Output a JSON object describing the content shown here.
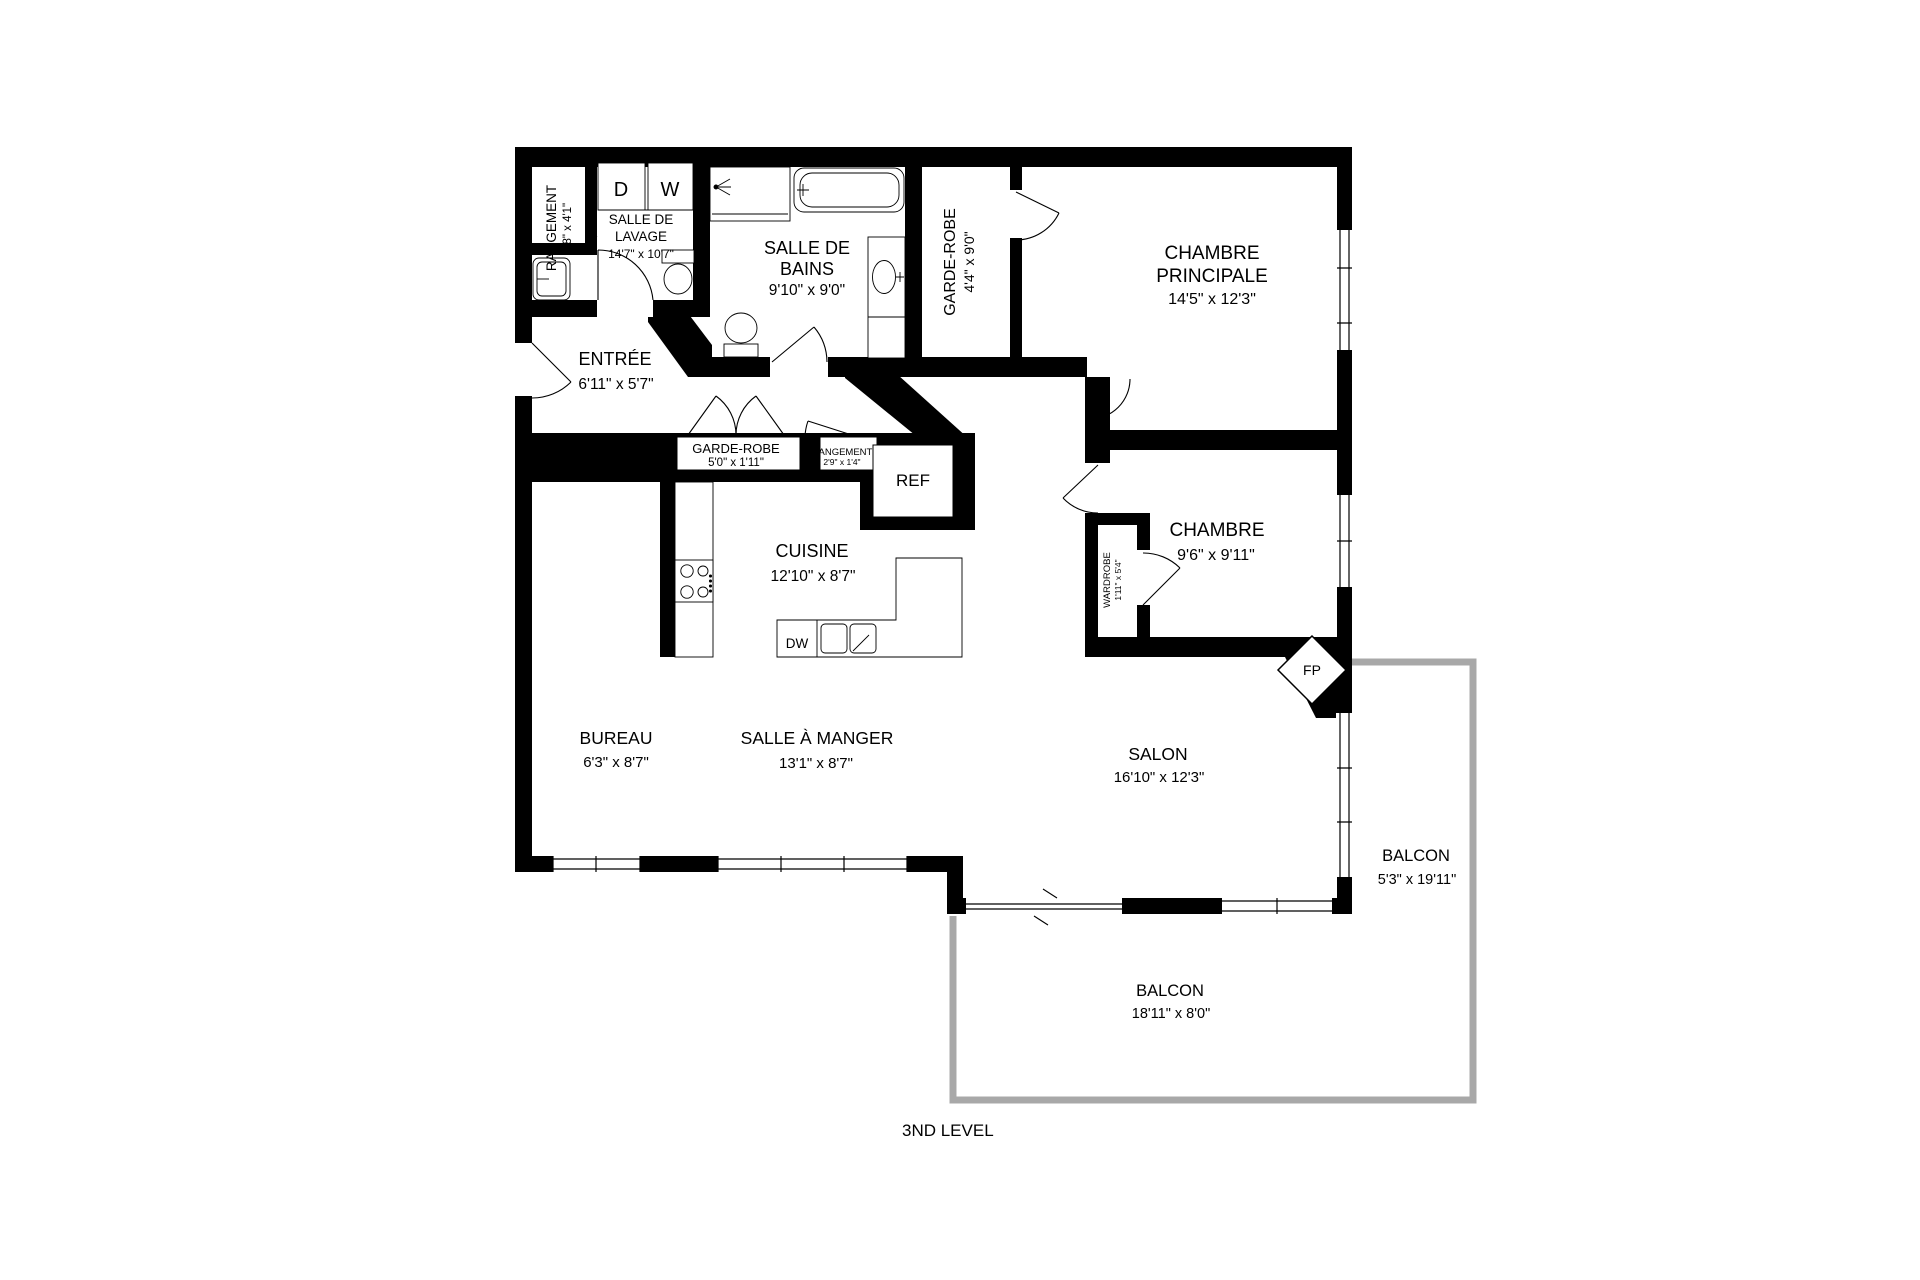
{
  "plan": {
    "title": "3ND LEVEL",
    "colors": {
      "wall": "#000000",
      "railing": "#a8a8a8",
      "text": "#000000",
      "background": "#ffffff"
    },
    "rooms": {
      "storage_closet": {
        "name": "RANGEMENT",
        "dims": "3'8\" x 4'1\""
      },
      "laundry": {
        "line1": "SALLE DE",
        "line2": "LAVAGE",
        "dims": "14'7\" x 10'7\""
      },
      "bathroom": {
        "line1": "SALLE DE",
        "line2": "BAINS",
        "dims": "9'10\" x 9'0\""
      },
      "walkin_closet": {
        "name": "GARDE-ROBE",
        "dims": "4'4\" x 9'0\""
      },
      "master_bedroom": {
        "line1": "CHAMBRE",
        "line2": "PRINCIPALE",
        "dims": "14'5\" x 12'3\""
      },
      "entry": {
        "name": "ENTRÉE",
        "dims": "6'11\" x 5'7\""
      },
      "hall_closet": {
        "name": "GARDE-ROBE",
        "dims": "5'0\" x 1'11\""
      },
      "hall_storage": {
        "name": "RANGEMENT",
        "dims": "2'9\" x 1'4\""
      },
      "kitchen": {
        "name": "CUISINE",
        "dims": "12'10\" x 8'7\""
      },
      "bedroom": {
        "name": "CHAMBRE",
        "dims": "9'6\" x 9'11\""
      },
      "wardrobe": {
        "name": "WARDROBE",
        "dims": "1'11\" x 5'4\""
      },
      "office": {
        "name": "BUREAU",
        "dims": "6'3\" x 8'7\""
      },
      "dining_room": {
        "name": "SALLE À MANGER",
        "dims": "13'1\" x 8'7\""
      },
      "living_room": {
        "name": "SALON",
        "dims": "16'10\" x 12'3\""
      },
      "balcony_right": {
        "name": "BALCON",
        "dims": "5'3\" x 19'11\""
      },
      "balcony_bottom": {
        "name": "BALCON",
        "dims": "18'11\" x 8'0\""
      }
    },
    "fixtures": {
      "dryer": "D",
      "washer": "W",
      "fridge": "REF",
      "dishwasher": "DW",
      "fireplace": "FP"
    }
  }
}
